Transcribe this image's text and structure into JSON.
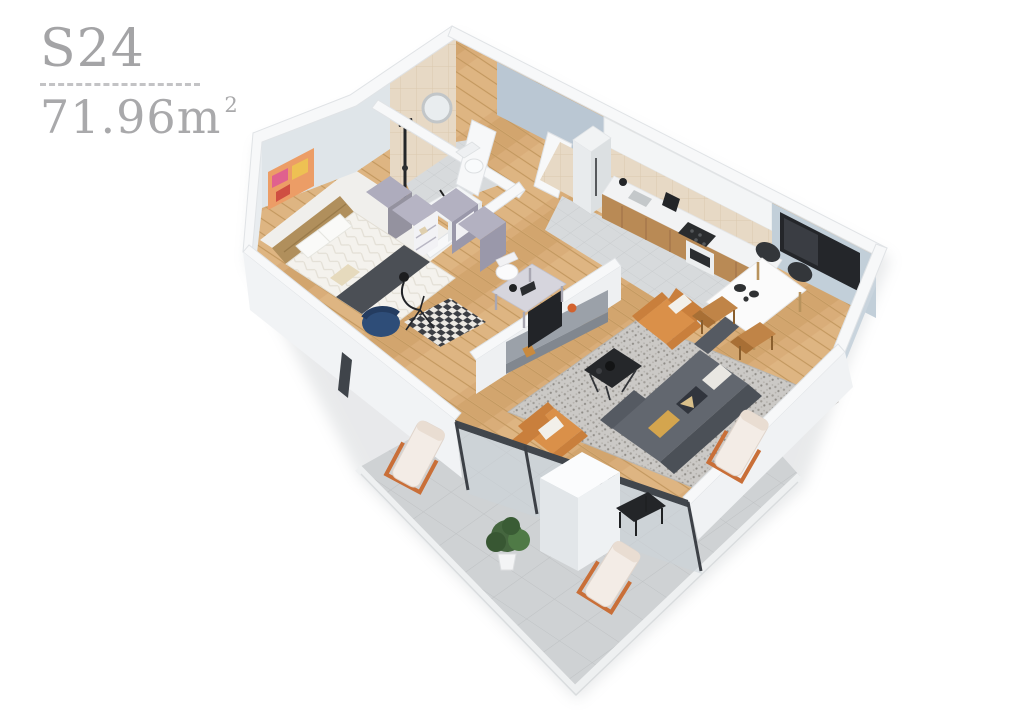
{
  "header": {
    "unit_code": "S24",
    "area_value": "71.96m",
    "area_exponent": "2"
  },
  "palette": {
    "background": "#ffffff",
    "label_text": "#a9a9ab",
    "divider_dashes": "#c3c3c5",
    "wall_white": "#f7f8f9",
    "wall_inner_face_blue": "#bac7d3",
    "bathroom_tile_beige": "#e7d9c5",
    "wood_floor": "#d9ad79",
    "gray_tile_floor": "#d8dadc",
    "terrace_tile": "#cfd2d4",
    "speckled_rug": "#cbc9c6",
    "sofa_gray": "#5f646c",
    "armchair_orange": "#da9049",
    "accent_chair_blue": "#2e4d78",
    "headboard_tan": "#b08f5c",
    "tv_black": "#24262a",
    "lounge_frame_orange": "#c96f38"
  },
  "floorplan": {
    "render_style": "isometric-3d-apartment-render",
    "rooms": [
      "bedroom",
      "bathroom",
      "shower-room",
      "hallway",
      "home-office-nook",
      "kitchen",
      "dining-area",
      "living-room",
      "terrace"
    ],
    "furniture": [
      "double-bed",
      "wall-art",
      "wardrobes",
      "hall-closets",
      "blue-accent-chair",
      "arc-floor-lamp",
      "desk-with-chair",
      "round-mirror",
      "shower-column",
      "washbasin",
      "toilet",
      "fridge",
      "kitchen-counter",
      "cooktop",
      "oven",
      "coffee-machine",
      "kettle",
      "wall-tv",
      "dining-table",
      "dining-chairs",
      "tv-sideboard",
      "media-tv",
      "gray-sofa",
      "orange-armchairs",
      "coffee-table",
      "speckled-rug",
      "checkered-runner",
      "lounge-chairs",
      "terrace-side-table",
      "potted-plant"
    ]
  }
}
